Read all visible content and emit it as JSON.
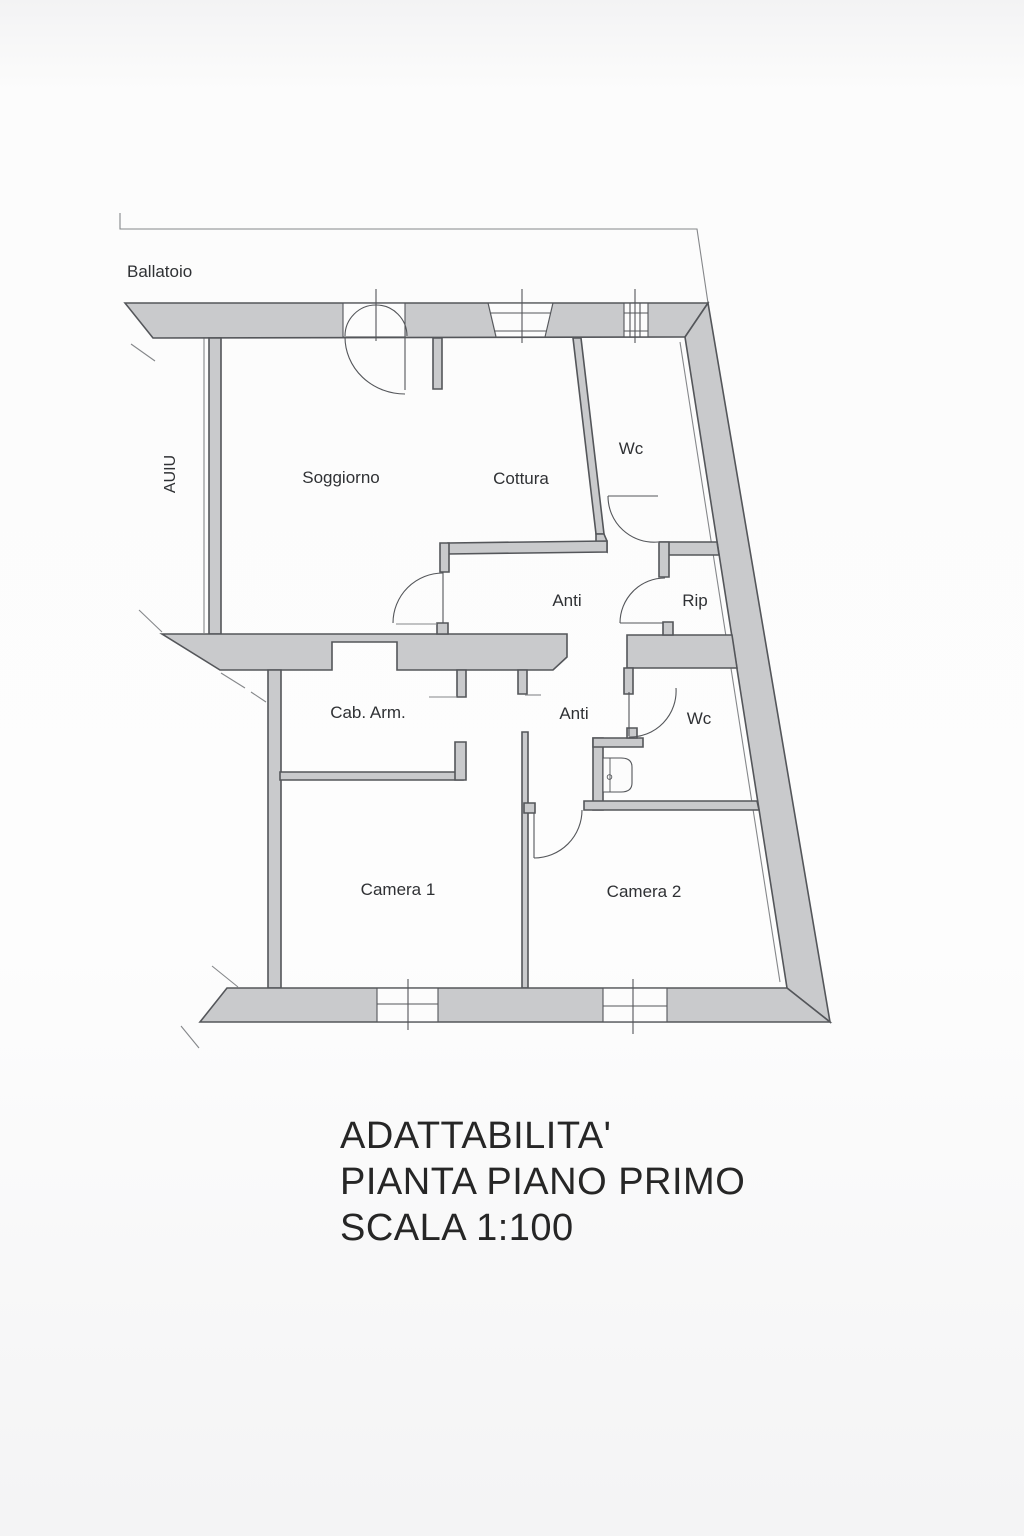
{
  "plan": {
    "balcony_label": "Ballatoio",
    "side_label": "AUIU",
    "rooms": [
      {
        "id": "soggiorno",
        "label": "Soggiorno"
      },
      {
        "id": "cottura",
        "label": "Cottura"
      },
      {
        "id": "wc-upper",
        "label": "Wc"
      },
      {
        "id": "anti-upper",
        "label": "Anti"
      },
      {
        "id": "rip",
        "label": "Rip"
      },
      {
        "id": "cab-arm",
        "label": "Cab. Arm."
      },
      {
        "id": "anti-lower",
        "label": "Anti"
      },
      {
        "id": "wc-lower",
        "label": "Wc"
      },
      {
        "id": "camera-1",
        "label": "Camera 1"
      },
      {
        "id": "camera-2",
        "label": "Camera 2"
      }
    ]
  },
  "title_block": {
    "line1": "ADATTABILITA'",
    "line2": "PIANTA PIANO PRIMO",
    "line3": "SCALA 1:100"
  },
  "colors": {
    "wall_fill": "#c9cacc",
    "wall_outline": "#54565a",
    "thin_line": "#85878a",
    "label_text": "#2f3134",
    "title_text": "#262626",
    "background": "#fafafa",
    "paper": "#fcfcfc"
  }
}
